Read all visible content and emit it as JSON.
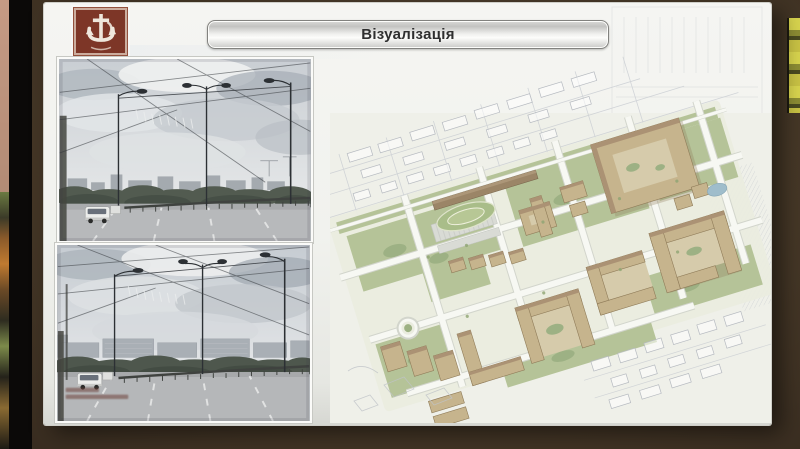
{
  "slide": {
    "title": "Візуалізація"
  },
  "emblem": {
    "icon": "anchor-coat-of-arms",
    "background_color": "#7d3627",
    "symbol_color": "#efe7dc"
  },
  "colors": {
    "room_background": "#463827",
    "screen_bezel": "#0b0908",
    "slide_background": "#f2f2ee",
    "title_text": "#2f2f2f",
    "plan_building_wall": "#c6b48d",
    "plan_building_roof": "#ab9274",
    "plan_green": "#b5c398",
    "plan_water": "#9fbdcb",
    "photo_sky": "#c9ced3",
    "photo_road": "#b7b9bb"
  }
}
